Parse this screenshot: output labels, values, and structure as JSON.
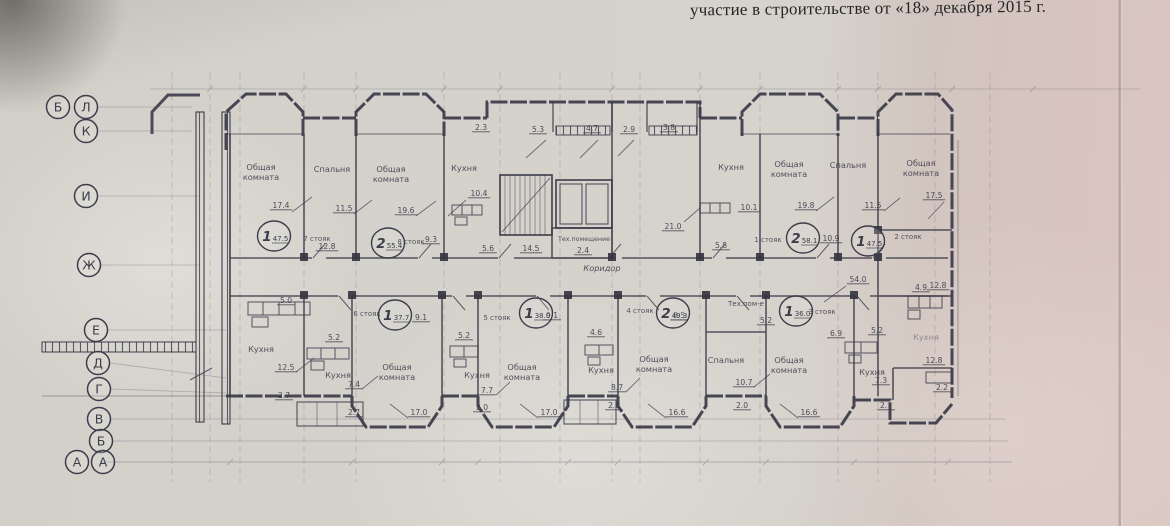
{
  "document": {
    "header_line": "участие в строительстве от «18» декабря 2015 г."
  },
  "colors": {
    "ink": "#3c3c4a",
    "paper": "#d6d3cd",
    "paper_pink": "#d7c4bf"
  },
  "plan": {
    "axis_circles": [
      {
        "l": "Б",
        "x": 58,
        "y": 107
      },
      {
        "l": "Л",
        "x": 86,
        "y": 107
      },
      {
        "l": "К",
        "x": 86,
        "y": 131
      },
      {
        "l": "И",
        "x": 86,
        "y": 196
      },
      {
        "l": "Ж",
        "x": 89,
        "y": 265
      },
      {
        "l": "Е",
        "x": 96,
        "y": 330
      },
      {
        "l": "Д",
        "x": 98,
        "y": 363
      },
      {
        "l": "Г",
        "x": 99,
        "y": 389
      },
      {
        "l": "В",
        "x": 99,
        "y": 419
      },
      {
        "l": "Б",
        "x": 101,
        "y": 441
      },
      {
        "l": "А",
        "x": 77,
        "y": 462
      },
      {
        "l": "А",
        "x": 103,
        "y": 462
      }
    ],
    "room_labels": [
      {
        "t": "Общая\nкомната",
        "x": 261,
        "y": 170
      },
      {
        "t": "Спальня",
        "x": 332,
        "y": 172
      },
      {
        "t": "Общая\nкомната",
        "x": 391,
        "y": 172
      },
      {
        "t": "Кухня",
        "x": 464,
        "y": 171
      },
      {
        "t": "Тех.помещение",
        "x": 584,
        "y": 241,
        "s": 6.3
      },
      {
        "t": "Коридор",
        "x": 602,
        "y": 271,
        "i": 1
      },
      {
        "t": "Кухня",
        "x": 731,
        "y": 170
      },
      {
        "t": "Общая\nкомната",
        "x": 789,
        "y": 167
      },
      {
        "t": "Спальня",
        "x": 848,
        "y": 168
      },
      {
        "t": "Общая\nкомната",
        "x": 921,
        "y": 166
      },
      {
        "t": "Кухня",
        "x": 261,
        "y": 352
      },
      {
        "t": "Кухня",
        "x": 338,
        "y": 378
      },
      {
        "t": "Общая\nкомната",
        "x": 397,
        "y": 370
      },
      {
        "t": "Кухня",
        "x": 477,
        "y": 378
      },
      {
        "t": "Общая\nкомната",
        "x": 522,
        "y": 370
      },
      {
        "t": "Кухня",
        "x": 601,
        "y": 373
      },
      {
        "t": "Общая\nкомната",
        "x": 654,
        "y": 362
      },
      {
        "t": "Тех.пом-е",
        "x": 746,
        "y": 306,
        "s": 7
      },
      {
        "t": "Спальня",
        "x": 726,
        "y": 363
      },
      {
        "t": "Общая\nкомната",
        "x": 789,
        "y": 363
      },
      {
        "t": "Кухня",
        "x": 872,
        "y": 375
      },
      {
        "t": "Кухня",
        "x": 926,
        "y": 340,
        "f": 1
      }
    ],
    "dims": [
      {
        "t": "2.3",
        "x": 481,
        "y": 130
      },
      {
        "t": "5.3",
        "x": 538,
        "y": 132
      },
      {
        "t": "4.7",
        "x": 592,
        "y": 131
      },
      {
        "t": "2.9",
        "x": 629,
        "y": 132
      },
      {
        "t": "3.8",
        "x": 669,
        "y": 130
      },
      {
        "t": "17.4",
        "x": 281,
        "y": 208
      },
      {
        "t": "11.5",
        "x": 344,
        "y": 211
      },
      {
        "t": "19.6",
        "x": 406,
        "y": 213
      },
      {
        "t": "10.4",
        "x": 479,
        "y": 196
      },
      {
        "t": "12.8",
        "x": 327,
        "y": 249
      },
      {
        "t": "9.3",
        "x": 431,
        "y": 242
      },
      {
        "t": "5.6",
        "x": 488,
        "y": 251
      },
      {
        "t": "14.5",
        "x": 531,
        "y": 251
      },
      {
        "t": "2.4",
        "x": 583,
        "y": 253
      },
      {
        "t": "21.0",
        "x": 673,
        "y": 229
      },
      {
        "t": "5.8",
        "x": 721,
        "y": 248
      },
      {
        "t": "10.1",
        "x": 749,
        "y": 210
      },
      {
        "t": "19.8",
        "x": 806,
        "y": 208
      },
      {
        "t": "11.5",
        "x": 873,
        "y": 208
      },
      {
        "t": "10.9",
        "x": 831,
        "y": 241
      },
      {
        "t": "17.5",
        "x": 934,
        "y": 198
      },
      {
        "t": "54.0",
        "x": 858,
        "y": 282
      },
      {
        "t": "4.9",
        "x": 921,
        "y": 290
      },
      {
        "t": "12.8",
        "x": 938,
        "y": 288
      },
      {
        "t": "5.0",
        "x": 286,
        "y": 303
      },
      {
        "t": "12.5",
        "x": 286,
        "y": 370
      },
      {
        "t": "5.2",
        "x": 334,
        "y": 340
      },
      {
        "t": "9.1",
        "x": 421,
        "y": 320
      },
      {
        "t": "7.4",
        "x": 354,
        "y": 387
      },
      {
        "t": "2.7",
        "x": 284,
        "y": 398
      },
      {
        "t": "2.7",
        "x": 354,
        "y": 415
      },
      {
        "t": "17.0",
        "x": 419,
        "y": 415
      },
      {
        "t": "5.2",
        "x": 464,
        "y": 338
      },
      {
        "t": "9.1",
        "x": 552,
        "y": 318
      },
      {
        "t": "7.7",
        "x": 487,
        "y": 393
      },
      {
        "t": "2.0",
        "x": 482,
        "y": 410
      },
      {
        "t": "17.0",
        "x": 549,
        "y": 415
      },
      {
        "t": "4.6",
        "x": 596,
        "y": 335
      },
      {
        "t": "8.7",
        "x": 617,
        "y": 390
      },
      {
        "t": "2.0",
        "x": 614,
        "y": 408
      },
      {
        "t": "16.6",
        "x": 677,
        "y": 415
      },
      {
        "t": "8.5",
        "x": 679,
        "y": 318
      },
      {
        "t": "5.2",
        "x": 766,
        "y": 323
      },
      {
        "t": "6.9",
        "x": 836,
        "y": 336
      },
      {
        "t": "5.2",
        "x": 877,
        "y": 333
      },
      {
        "t": "10.7",
        "x": 744,
        "y": 385
      },
      {
        "t": "2.0",
        "x": 742,
        "y": 408
      },
      {
        "t": "16.6",
        "x": 809,
        "y": 415
      },
      {
        "t": "7.3",
        "x": 881,
        "y": 383
      },
      {
        "t": "2.7",
        "x": 886,
        "y": 408
      },
      {
        "t": "12.8",
        "x": 934,
        "y": 363
      },
      {
        "t": "2.2",
        "x": 942,
        "y": 390
      }
    ],
    "apartments": [
      {
        "n": "1",
        "a": "47.5",
        "x": 271,
        "y": 238
      },
      {
        "n": "2",
        "a": "55.4",
        "x": 385,
        "y": 245
      },
      {
        "n": "2",
        "a": "58.1",
        "x": 800,
        "y": 240
      },
      {
        "n": "1",
        "a": "47.5",
        "x": 865,
        "y": 243
      },
      {
        "n": "1",
        "a": "37.7",
        "x": 392,
        "y": 317
      },
      {
        "n": "1",
        "a": "38.0",
        "x": 533,
        "y": 315
      },
      {
        "n": "2",
        "a": "49.3",
        "x": 670,
        "y": 315
      },
      {
        "n": "1",
        "a": "36.0",
        "x": 793,
        "y": 313
      }
    ],
    "stoyak_labels": [
      {
        "t": "7 стояк",
        "x": 317,
        "y": 241
      },
      {
        "t": "8 стояк",
        "x": 411,
        "y": 244
      },
      {
        "t": "1 стояк",
        "x": 768,
        "y": 242
      },
      {
        "t": "2 стояк",
        "x": 908,
        "y": 239
      },
      {
        "t": "6 стояк",
        "x": 367,
        "y": 316
      },
      {
        "t": "5 стояк",
        "x": 497,
        "y": 320
      },
      {
        "t": "4 стояк",
        "x": 640,
        "y": 313
      },
      {
        "t": "3 стояк",
        "x": 822,
        "y": 314
      }
    ]
  }
}
